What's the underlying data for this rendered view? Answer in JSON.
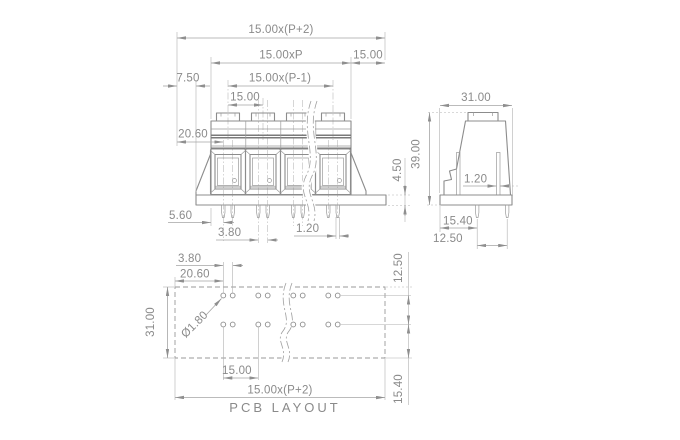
{
  "drawing": {
    "title": "PCB LAYOUT",
    "colors": {
      "line": "#8c8c8c",
      "dimension": "#a5a5a5",
      "text": "#8a8a8a",
      "background": "#ffffff"
    },
    "front_view": {
      "dims": {
        "overall_width": "15.00x(P+2)",
        "body_width": "15.00xP",
        "edge_margin": "15.00",
        "base_offset": "7.50",
        "pole_span": "15.00x(P-1)",
        "pitch": "15.00",
        "first_pin_offset": "20.60",
        "base_height": "4.50",
        "body_to_pin": "5.60",
        "pin_pair_spacing": "3.80",
        "pin_width": "1.20"
      }
    },
    "side_view": {
      "dims": {
        "depth": "31.00",
        "height": "39.00",
        "pin_width": "1.20",
        "pin_row_span": "15.40",
        "pin_to_front": "12.50"
      }
    },
    "pcb_layout": {
      "label": "PCB LAYOUT",
      "dims": {
        "hole_pair_spacing": "3.80",
        "first_hole_offset": "20.60",
        "depth": "31.00",
        "hole_diameter": "Ø1.80",
        "pitch": "15.00",
        "overall_width": "15.00x(P+2)",
        "row_spacing": "12.50",
        "row_to_edge": "15.40"
      }
    }
  }
}
